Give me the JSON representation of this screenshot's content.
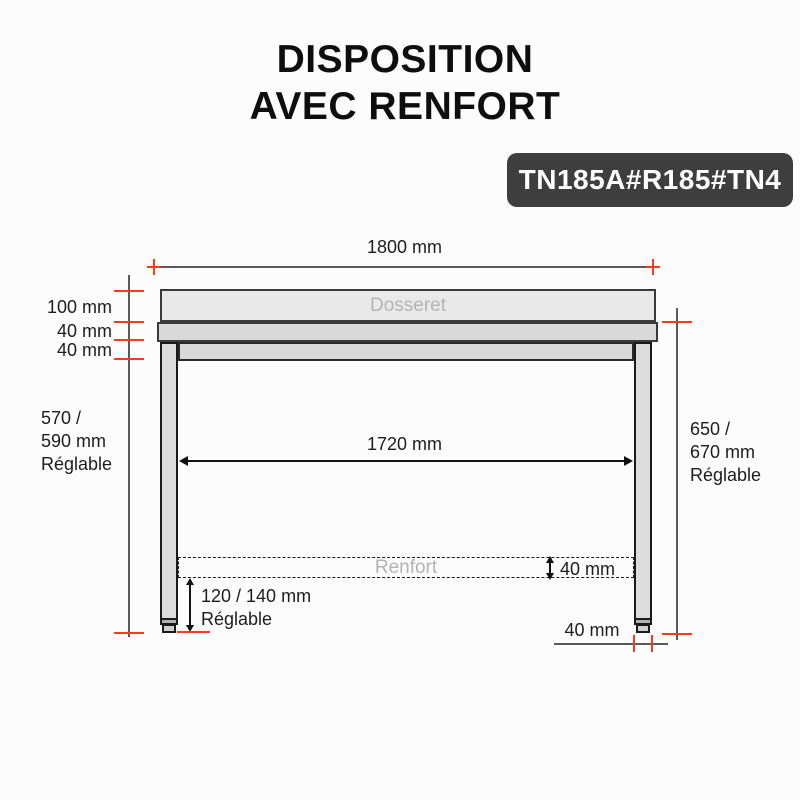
{
  "title": {
    "line1": "DISPOSITION",
    "line2": "AVEC RENFORT"
  },
  "badge": {
    "label": "TN185A#R185#TN4"
  },
  "diagram": {
    "part_labels": {
      "backsplash": "Dosseret",
      "reinforcement": "Renfort"
    },
    "dimensions": {
      "total_width": "1800 mm",
      "backsplash_height": "100 mm",
      "worktop_thickness": "40 mm",
      "frame_thickness": "40 mm",
      "left_clearance_line1": "570 /",
      "left_clearance_line2": "590 mm",
      "left_clearance_line3": "Réglable",
      "inner_width": "1720 mm",
      "right_height_line1": "650 /",
      "right_height_line2": "670 mm",
      "right_height_line3": "Réglable",
      "reinforcement_thickness": "40 mm",
      "foot_adjust_line1": "120 / 140 mm",
      "foot_adjust_line2": "Réglable",
      "leg_width": "40 mm"
    },
    "colors": {
      "accent_red": "#f93a1d",
      "line_gray": "#5a5a5a",
      "arrow_black": "#111111",
      "steel_light": "#e9e9e9",
      "steel_mid": "#d9d9d9",
      "badge_bg": "#3e3e3e",
      "muted_label": "#b4b4b4"
    }
  }
}
